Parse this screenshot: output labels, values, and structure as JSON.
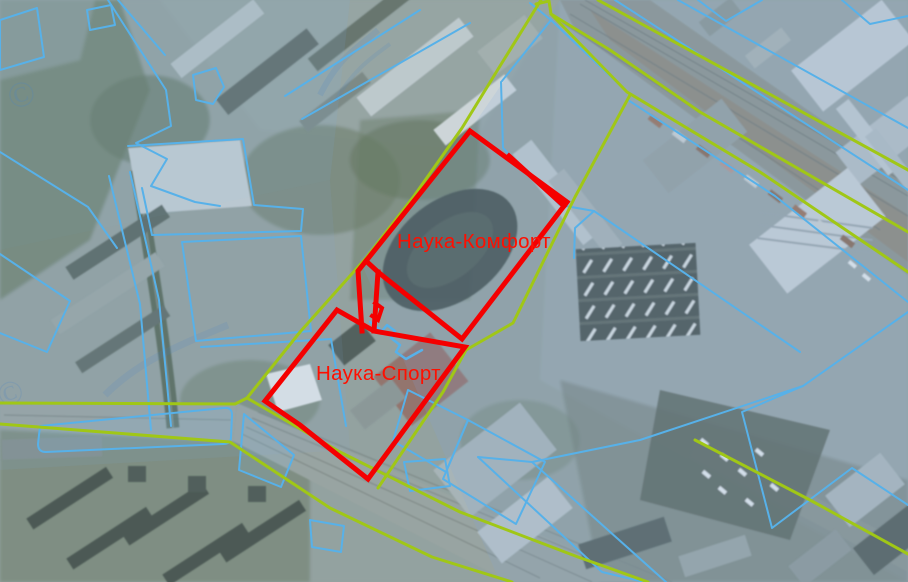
{
  "map": {
    "selected_parcels": [
      {
        "label": "Наука-Комфорт"
      },
      {
        "label": "Наука-Спорт"
      }
    ],
    "watermark_symbol": "©"
  },
  "colors": {
    "selection_outline": "#f40000",
    "label_text": "#ff0f00",
    "land_boundary": "#a0c716",
    "parcel_outline": "#57b1e9"
  }
}
